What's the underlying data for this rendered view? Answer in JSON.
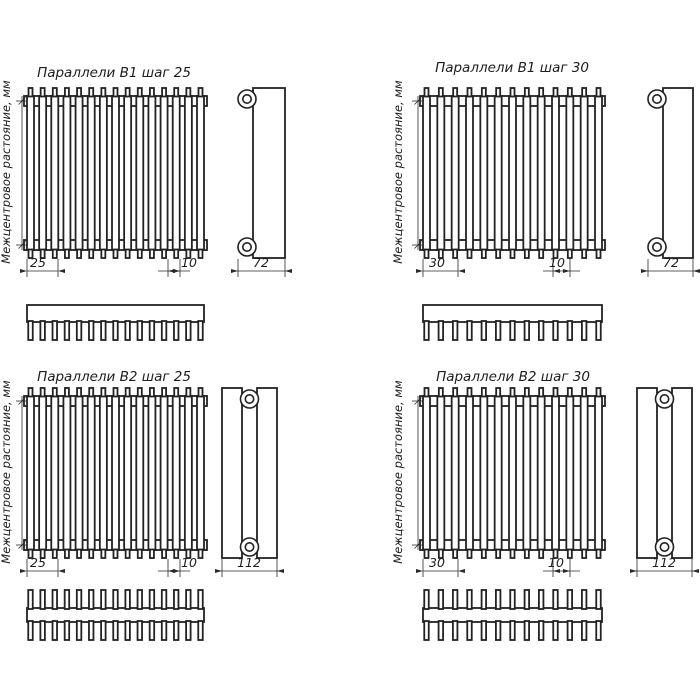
{
  "page": {
    "background": "#ffffff",
    "line_color": "#222222"
  },
  "vertical_axis_label": "Межцентровое растояние, мм",
  "quadrants": [
    {
      "title": "Параллели В1 шаг 25",
      "model": "В1",
      "step": "25",
      "tubes": 15,
      "rows": 1,
      "dims": {
        "step": "25",
        "tube_width": "10",
        "depth": "72"
      }
    },
    {
      "title": "Параллели В1 шаг 30",
      "model": "В1",
      "step": "30",
      "tubes": 13,
      "rows": 1,
      "dims": {
        "step": "30",
        "tube_width": "10",
        "depth": "72"
      }
    },
    {
      "title": "Параллели В2 шаг 25",
      "model": "В2",
      "step": "25",
      "tubes": 15,
      "rows": 2,
      "dims": {
        "step": "25",
        "tube_width": "10",
        "depth": "112"
      }
    },
    {
      "title": "Параллели В2 шаг 30",
      "model": "В2",
      "step": "30",
      "tubes": 13,
      "rows": 2,
      "dims": {
        "step": "30",
        "tube_width": "10",
        "depth": "112"
      }
    }
  ]
}
